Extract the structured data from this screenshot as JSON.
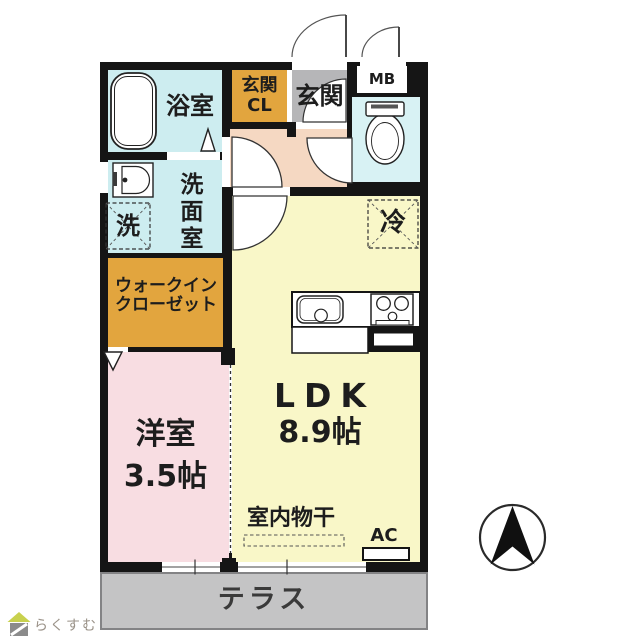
{
  "plan": {
    "bathroom": {
      "label": "浴室"
    },
    "entrance_closet": {
      "label": "玄関\nCL"
    },
    "entrance": {
      "label": "玄関"
    },
    "meter_box": {
      "label": "MB"
    },
    "washroom": {
      "label": "洗面室"
    },
    "washing_machine": {
      "label": "洗"
    },
    "walk_in_closet": {
      "label": "ウォークイン\nクローゼット"
    },
    "refrigerator": {
      "label": "冷"
    },
    "ldk": {
      "label": "LDK",
      "size": "8.9帖"
    },
    "western_room": {
      "label": "洋室",
      "size": "3.5帖"
    },
    "indoor_drying": {
      "label": "室内物干"
    },
    "air_conditioner": {
      "label": "AC"
    },
    "terrace": {
      "label": "テラス"
    },
    "logo": {
      "text": "らくすむ"
    },
    "compass": {
      "direction": "north"
    },
    "colors": {
      "wall_black": "#151515",
      "bathroom_cyan": "#cdedf0",
      "toilet_cyan": "#d8f2f4",
      "closet_gold": "#e2a53e",
      "entrance_gray": "#b6b6b8",
      "hall_peach": "#f5d8c2",
      "ldk_yellow": "#f9f7c8",
      "room_pink": "#f8dde2",
      "terrace_gray": "#c4c4c5",
      "logo_green": "#c8d14e"
    }
  }
}
